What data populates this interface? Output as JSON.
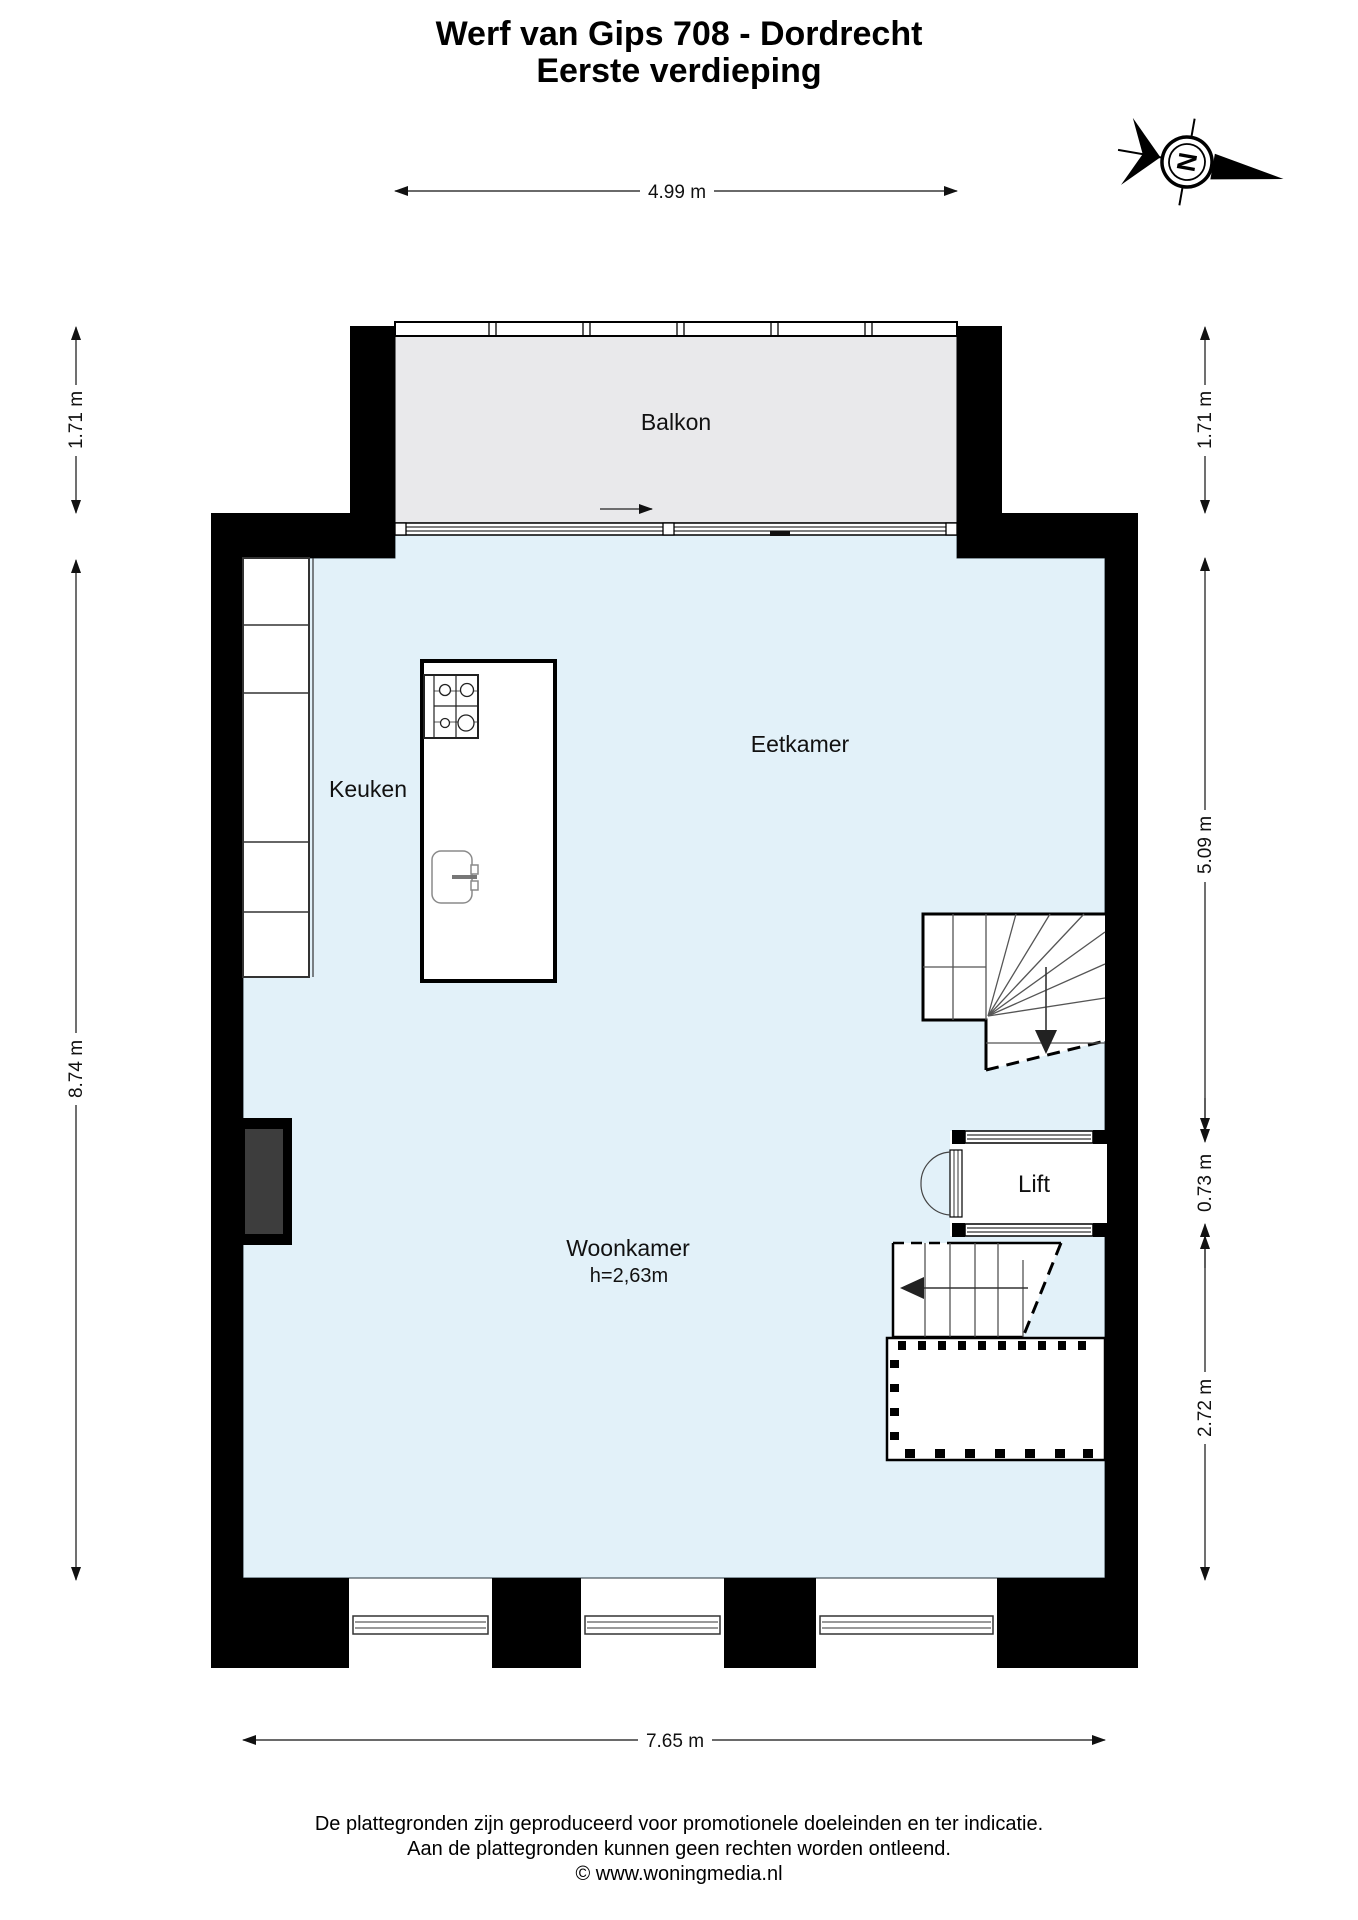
{
  "title": {
    "line1": "Werf van Gips 708 - Dordrecht",
    "line2": "Eerste verdieping"
  },
  "compass": {
    "north_label": "N"
  },
  "rooms": {
    "balkon": "Balkon",
    "keuken": "Keuken",
    "eetkamer": "Eetkamer",
    "woonkamer": "Woonkamer",
    "woonkamer_height": "h=2,63m",
    "lift": "Lift"
  },
  "dimensions": {
    "top_width": "4.99 m",
    "left_balcony_depth": "1.71 m",
    "right_balcony_depth": "1.71 m",
    "left_height": "8.74 m",
    "right_upper": "5.09 m",
    "right_lift": "0.73 m",
    "right_lower": "2.72 m",
    "bottom_width": "7.65 m"
  },
  "footer": {
    "line1": "De plattegronden zijn geproduceerd voor promotionele doeleinden en ter indicatie.",
    "line2": "Aan de plattegronden kunnen geen rechten worden ontleend.",
    "line3": "© www.woningmedia.nl"
  },
  "colors": {
    "floor": "#e2f1f9",
    "balcony": "#e9e9eb",
    "wall": "#000000",
    "shaft": "#3d3d3d"
  }
}
